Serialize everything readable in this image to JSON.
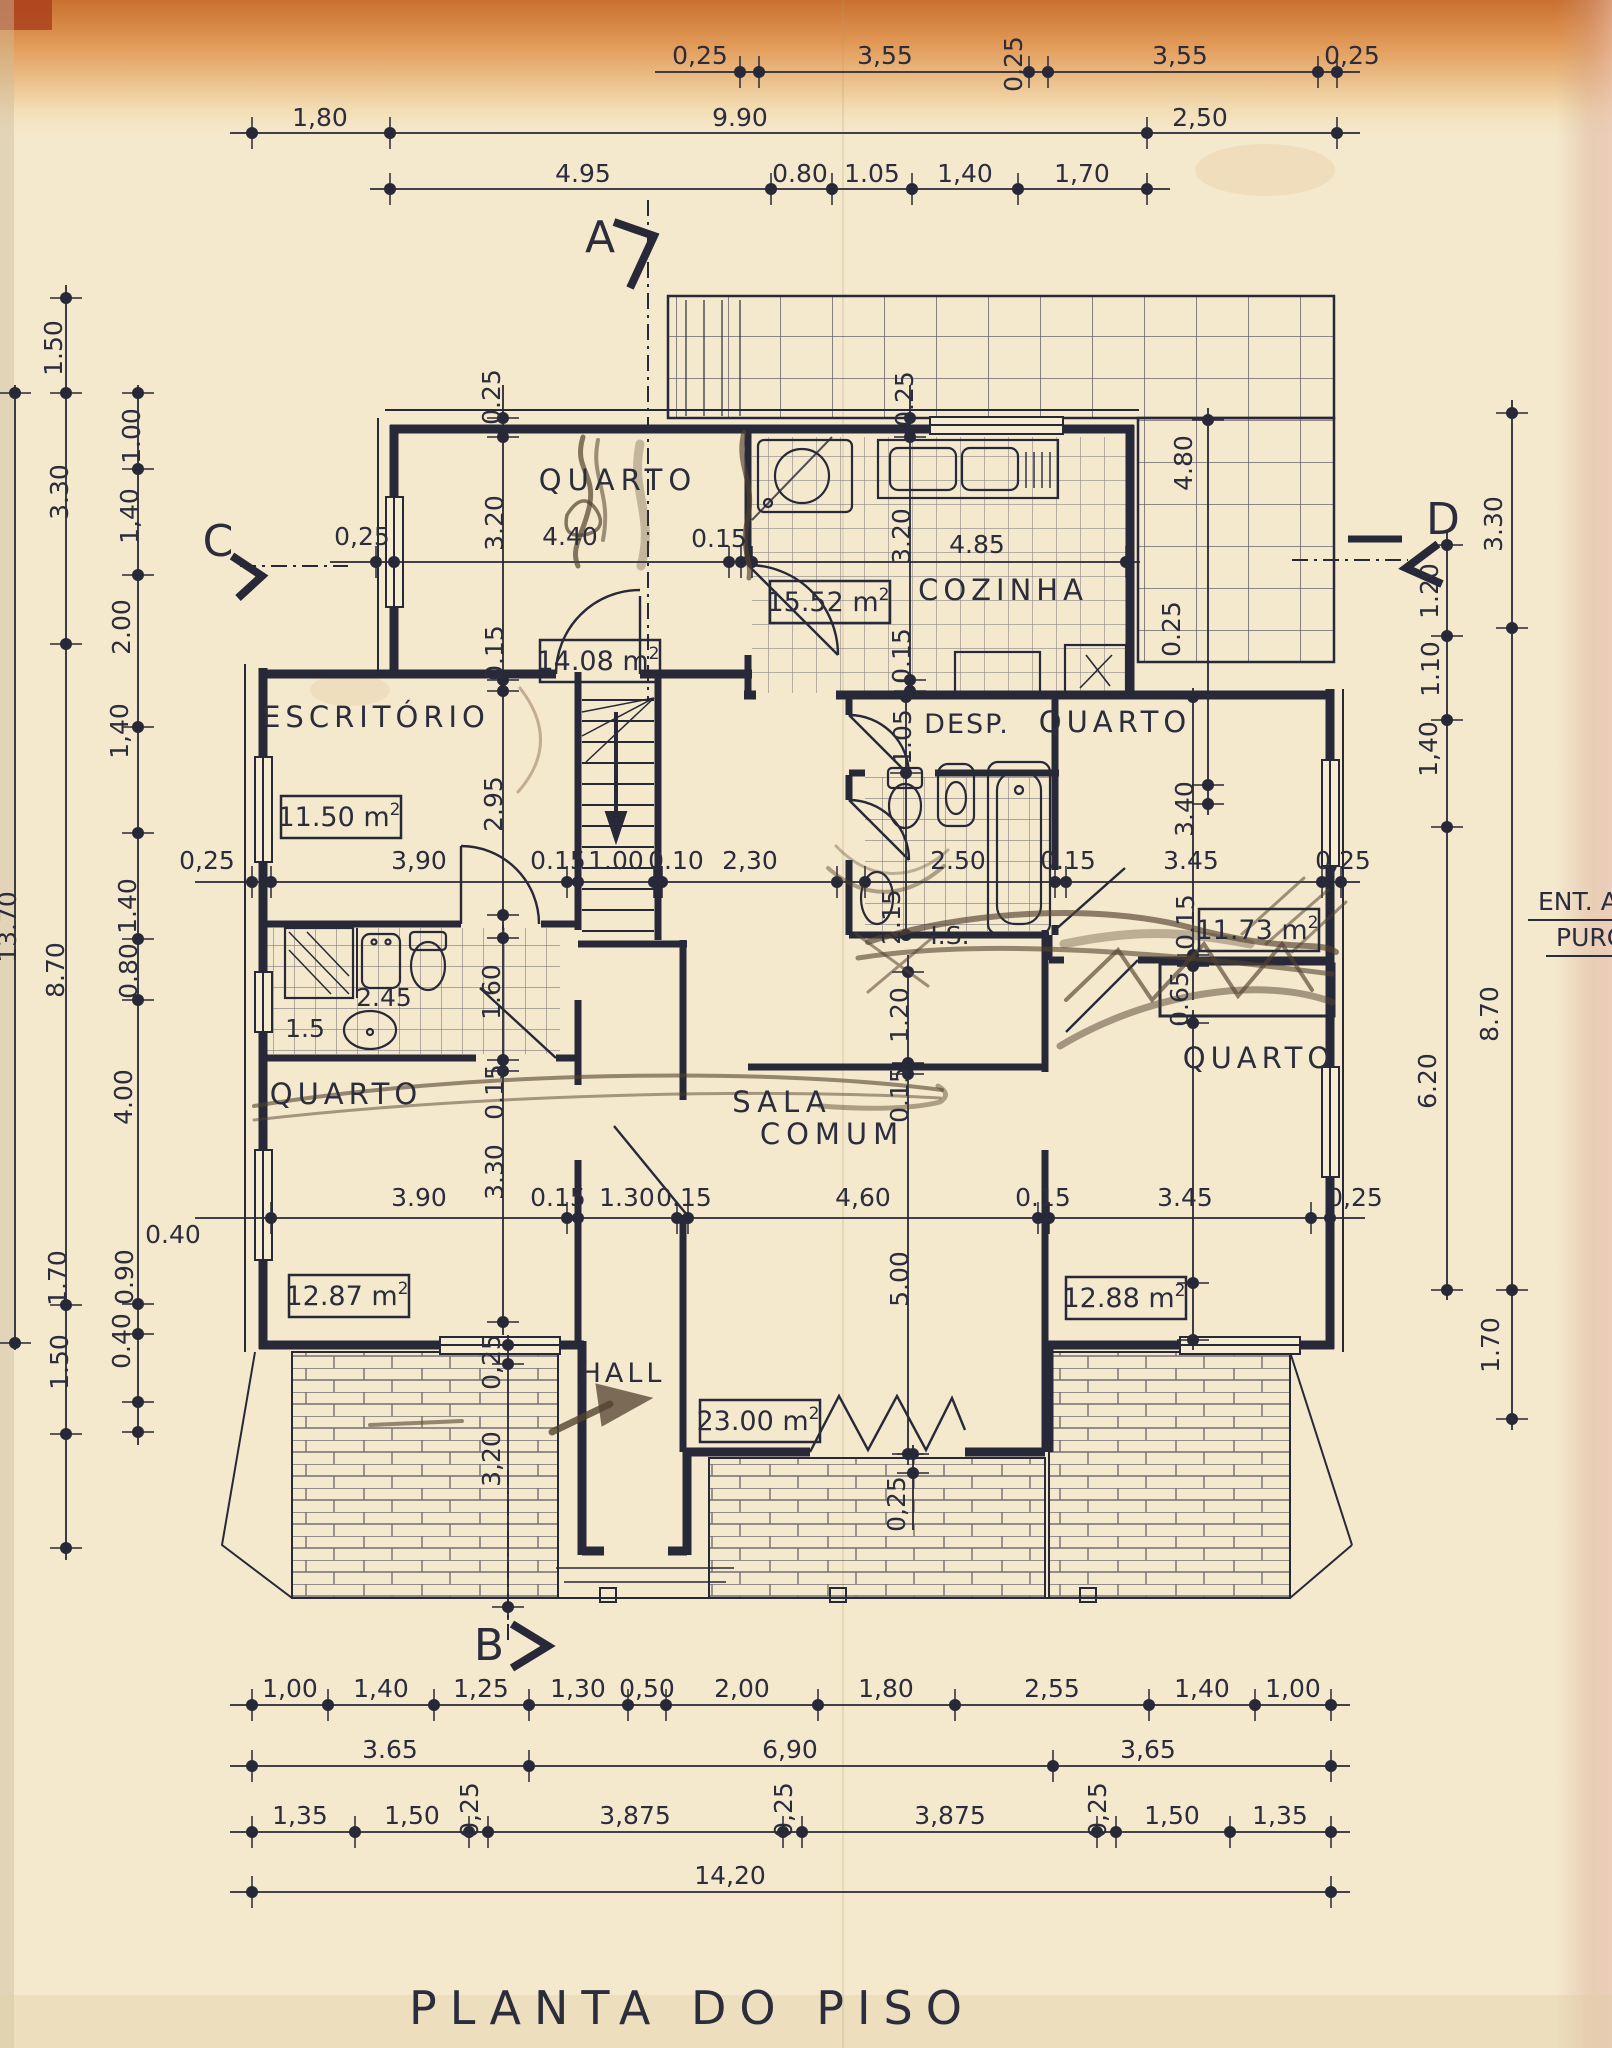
{
  "title": "PLANTA DO PISO",
  "side_notes": {
    "line1": "ENT. A",
    "line2": "PURO"
  },
  "section_markers": [
    "A",
    "B",
    "C",
    "D"
  ],
  "rooms": [
    {
      "label": "QUARTO",
      "area_m2": "14.08"
    },
    {
      "label": "COZINHA",
      "area_m2": "15.52"
    },
    {
      "label": "ESCRITÓRIO",
      "area_m2": "11.50"
    },
    {
      "label": "DESP."
    },
    {
      "label": "QUARTO",
      "area_m2": "11.73"
    },
    {
      "label": "I.S."
    },
    {
      "label": "QUARTO",
      "area_m2": "12.87"
    },
    {
      "label": "SALA COMUM",
      "area_m2": "23.00"
    },
    {
      "label": "HALL"
    },
    {
      "label": "QUARTO",
      "area_m2": "12.88"
    }
  ],
  "dimensions": {
    "top": [
      "0,25",
      "3,55",
      "0,25",
      "3,55",
      "0,25",
      "1,80",
      "9.90",
      "2,50",
      "4.95",
      "0.80",
      "1.05",
      "1,40",
      "1,70"
    ],
    "left": [
      "1.50",
      "3.30",
      "13.70",
      "8.70",
      "1.70",
      "1.50",
      "1.00",
      "1,40",
      "2.00",
      "1,40",
      "1.40",
      "0.80",
      "4.00",
      "0.40",
      "0.90",
      "0.40"
    ],
    "right": [
      "3.30",
      "1.20",
      "1.10",
      "1,40",
      "8.70",
      "6.20",
      "1.70",
      "4.80",
      "0.25"
    ],
    "bottom": [
      "1,00",
      "1,40",
      "1,25",
      "1,30",
      "0,50",
      "2,00",
      "1,80",
      "2,55",
      "1,40",
      "1,00",
      "3.65",
      "6,90",
      "3,65",
      "1,35",
      "1,50",
      "0,25",
      "3,875",
      "0,25",
      "3,875",
      "0,25",
      "1,50",
      "1,35",
      "14,20"
    ],
    "interior": [
      "0.25",
      "3.20",
      "0,25",
      "4.40",
      "0.15",
      "0.15",
      "0.25",
      "3.20",
      "4.85",
      "0.15",
      "2.95",
      "0,25",
      "3,90",
      "0.15",
      "1.00",
      "0.10",
      "2,30",
      "2.50",
      "0.15",
      "3.45",
      "0,25",
      "1.05",
      "3.40",
      "0.15",
      "2.15",
      "1.20",
      "0.65",
      "2.45",
      "1.60",
      "1.5",
      "0.15",
      "3.30",
      "0.15",
      "5.00",
      "3.90",
      "0.15",
      "1.30",
      "0.15",
      "4,60",
      "0.15",
      "3.45",
      "0,25",
      "0,25",
      "3,20",
      "0,25"
    ]
  }
}
